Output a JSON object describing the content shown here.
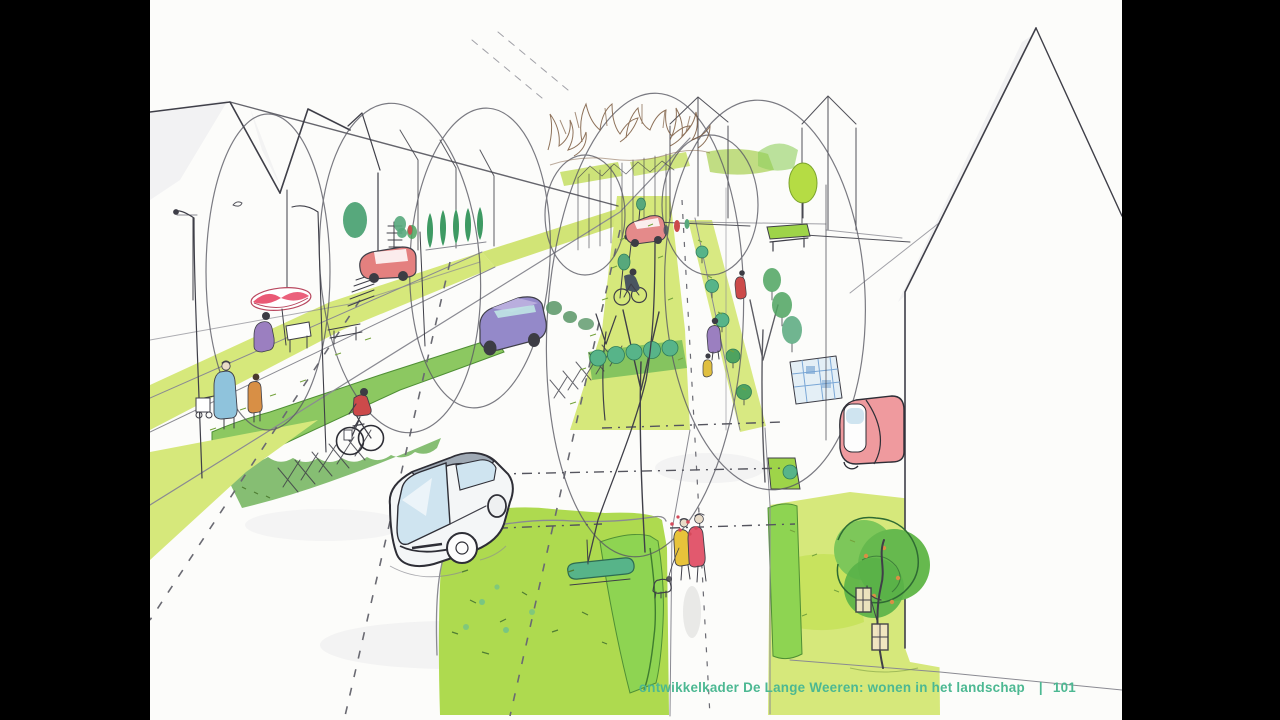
{
  "footer": {
    "caption": "ontwikkelkader De Lange Weeren: wonen in het landschap",
    "separator": "|",
    "page_number": "101"
  },
  "scene": {
    "style": "hand-drawn marker and watercolor sketch",
    "subject": "aerial perspective of a residential street with wide green verges",
    "vehicles": [
      "red-car-left-street",
      "purple-car-main-road",
      "grey-car-foreground",
      "small-red-car-distance",
      "red-car-parked-right"
    ],
    "people": [
      "pedestrian-blue-with-cart",
      "child-orange",
      "cyclist-red",
      "seated-person-purple-terrace",
      "cyclist-dark-distance",
      "walker-purple",
      "child-yellow",
      "walker-yellow",
      "walker-red",
      "dog-on-leash",
      "tiny-distant-figures"
    ],
    "vegetation": [
      "large-tree-crown-outlines",
      "bare-branch-scribbles",
      "cypress-row",
      "bright-ball-tree",
      "median-grass-strip",
      "clipped-hedges",
      "foreground-lawn",
      "right-lawn",
      "dark-tree-with-lanterns",
      "teal-shrubs"
    ],
    "street_elements": [
      "main-road-dashes",
      "crosswalk-hatching",
      "terrace-steps",
      "blue-grid-paving",
      "street-lamps",
      "red-white-parasol",
      "terrace-table",
      "bench",
      "teal-log-bench",
      "lantern-boxes"
    ]
  },
  "palette": {
    "frame": "#000000",
    "paper": "#fcfcfa",
    "ink": "#3f3f48",
    "ink_soft": "#8a8a92",
    "grass": "#d6e87b",
    "grass_bright": "#c4e157",
    "lawn": "#aeda4f",
    "hedge": "#8cc861",
    "hedge_dark": "#5faa45",
    "hedge_bright": "#8ed452",
    "foliage_dark": "#4ea35f",
    "teal_shrub": "#57b489",
    "tree_ball": "#b5dc44",
    "tree_dark": "#66b94e",
    "tree_mid": "#7dc75a",
    "branch_brown": "#7b5a3f",
    "car_red": "#e4807f",
    "car_pink": "#ef9a9e",
    "car_purple": "#9489c9",
    "car_purple_light": "#b9aede",
    "car_grey": "#9fa9b4",
    "glass_blue": "#cfe4f0",
    "parasol_red": "#e9506e",
    "person_blue": "#8fc3dc",
    "person_orange": "#d88f45",
    "person_red": "#cc4a4a",
    "person_yellow": "#e8c33a",
    "person_pink": "#e2596e",
    "person_purple": "#9b7fc0",
    "grid_blue": "#7aa7d6",
    "footer_green": "#4cb892",
    "speckle": "#74a23c",
    "speckle_dark": "#4f7d33",
    "skin": "#e9dcc8",
    "hair": "#3c3c44",
    "wash": "#e9e9ec",
    "flower_red": "#d4495a"
  }
}
